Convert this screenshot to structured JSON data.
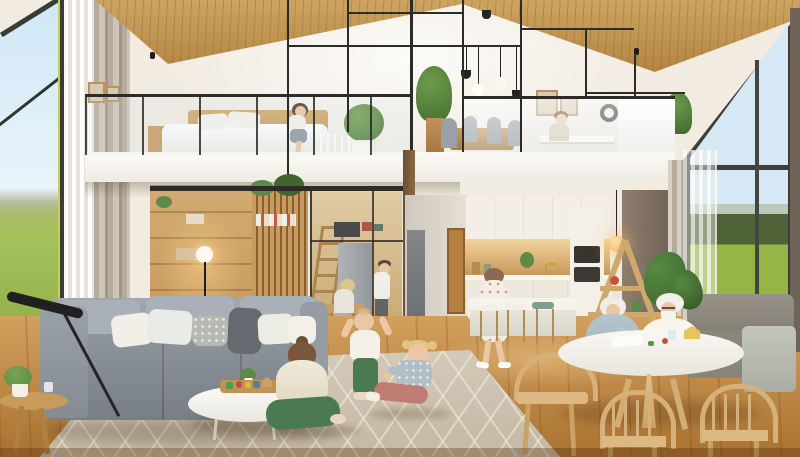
{
  "scene": {
    "title": "Multigenerational family home interior",
    "description": "Photorealistic render of a bright two-story open-plan house with a vaulted wood-plank ceiling, a loft level behind black metal framing, tall windows onto green fields, children playing on a rug, grandparents crafting at a round table, and warm wood finishes throughout",
    "regions": {
      "left_window": {
        "label": "Tall corner window with blue sky and green field view, sheer and beige curtains"
      },
      "loft_bedroom": {
        "label": "Loft bedroom with white bed, wood headboard, seated woman, topiary plant and glass railing"
      },
      "loft_dining": {
        "label": "Loft dining and work area with wood table, gray chairs, pendant lights, wall clock and desk"
      },
      "metal_frame": {
        "label": "Black steel frame structure and glass balustrades of the mezzanine"
      },
      "shelving_wall": {
        "label": "Warm-lit wooden shelving and slatted screen behind the sofa"
      },
      "kitchen_nook": {
        "label": "Glass-enclosed kitchen nook with fridge, ladder shelf and two people at a wooden table"
      },
      "hallway": {
        "label": "Central hallway with gray and wooden doors"
      },
      "kitchen": {
        "label": "Open kitchen with white cabinets, wood backsplash, oven column, island and bar stools"
      },
      "living_room": {
        "label": "Living room with gray sectional sofa, pillows, white oval coffee table with toy tray, and patterned rug"
      },
      "dining_corner": {
        "label": "Dining corner with round white table, spindle wood chairs and gray settee"
      },
      "right_window": {
        "label": "Floor-to-ceiling window with lawn and tree line view, sheer curtain"
      },
      "floor": {
        "label": "Warm oak plank flooring"
      }
    },
    "people": [
      {
        "id": "loft-woman",
        "label": "Woman sitting on the loft bed"
      },
      {
        "id": "loft-worker",
        "label": "Person working at the loft desk"
      },
      {
        "id": "nook-woman",
        "label": "Blonde woman seated at the nook table"
      },
      {
        "id": "nook-man",
        "label": "Man in white shirt standing in the kitchen nook"
      },
      {
        "id": "walking-woman",
        "label": "Woman in white floral dress walking through the kitchen"
      },
      {
        "id": "grandmother",
        "label": "White-haired grandmother in blue-gray cardigan crafting at the round table"
      },
      {
        "id": "grandfather",
        "label": "White-haired grandfather with glasses and beard at the round table"
      },
      {
        "id": "girl-ponytail",
        "label": "Girl with brown ponytail in cream sweater and green pants sitting on the rug"
      },
      {
        "id": "toddler",
        "label": "Toddler in white top and green pants standing with raised arms"
      },
      {
        "id": "girl-pigtails",
        "label": "Blonde girl with pigtails in polka-dot top and rose pants sitting on the rug"
      }
    ]
  },
  "palette": {
    "wall": "#f1ebe1",
    "wood_ceiling": "#cda461",
    "frame_black": "#2c2b28",
    "slab": "#fcfaf6",
    "sky": "#cfe7f6",
    "field": "#a6c25d",
    "treeline_right": "#4f6238",
    "curtain": "#cfc5b7",
    "floor": "#d29f5d",
    "floor_dark": "#aa7231",
    "rug": "#c4b8a4",
    "sofa": "#8d939b",
    "pillow": "#f1efe8",
    "throw": "#656970",
    "wood_furniture": "#d6b07a",
    "kitchen_wood": "#c9985c",
    "cabinet": "#f3efe7",
    "fridge": "#8d9196",
    "dark_wall": "#8d7e6e",
    "cardigan": "#b7c5cd",
    "plant": "#5d8a46",
    "plant_dark": "#3f662f",
    "skin": "#ecc7a4",
    "hair_brown": "#7a573a",
    "hair_blond": "#e3c47e",
    "hair_white": "#f0ede6",
    "green_pants": "#4c7a50",
    "rose_pants": "#c07b72",
    "glow": "#ffd27d"
  }
}
